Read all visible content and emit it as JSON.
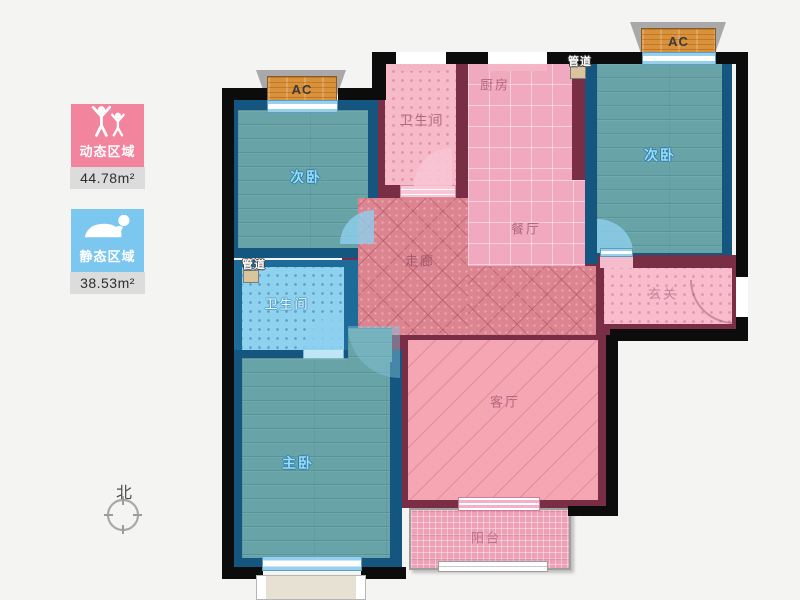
{
  "legend": {
    "dynamic": {
      "label": "动态区域",
      "area": "44.78m²",
      "color": "#f2849d"
    },
    "static": {
      "label": "静态区域",
      "area": "38.53m²",
      "color": "#7cc7ef"
    }
  },
  "compass": {
    "north_label": "北"
  },
  "rooms": {
    "bedroom_left": {
      "label": "次卧"
    },
    "bedroom_right": {
      "label": "次卧"
    },
    "bathroom_top": {
      "label": "卫生间"
    },
    "bathroom_left": {
      "label": "卫生间"
    },
    "kitchen": {
      "label": "厨房"
    },
    "dining": {
      "label": "餐厅"
    },
    "corridor": {
      "label": "走廊"
    },
    "entry": {
      "label": "玄关"
    },
    "living": {
      "label": "客厅"
    },
    "master": {
      "label": "主卧"
    },
    "balcony": {
      "label": "阳台"
    }
  },
  "fixtures": {
    "ac_left": {
      "label": "AC"
    },
    "ac_right": {
      "label": "AC"
    },
    "duct_top": {
      "label": "管道"
    },
    "duct_left": {
      "label": "管道"
    }
  },
  "colors": {
    "dynamic_zone": "#f2849d",
    "static_zone": "#7cc7ef",
    "wall_exterior": "#0c0c0c",
    "wall_pink_zone": "#7a2e45",
    "wall_blue_zone": "#14567f",
    "floor_teal": "#68a4a7",
    "floor_pink": "#f1a9bf"
  }
}
